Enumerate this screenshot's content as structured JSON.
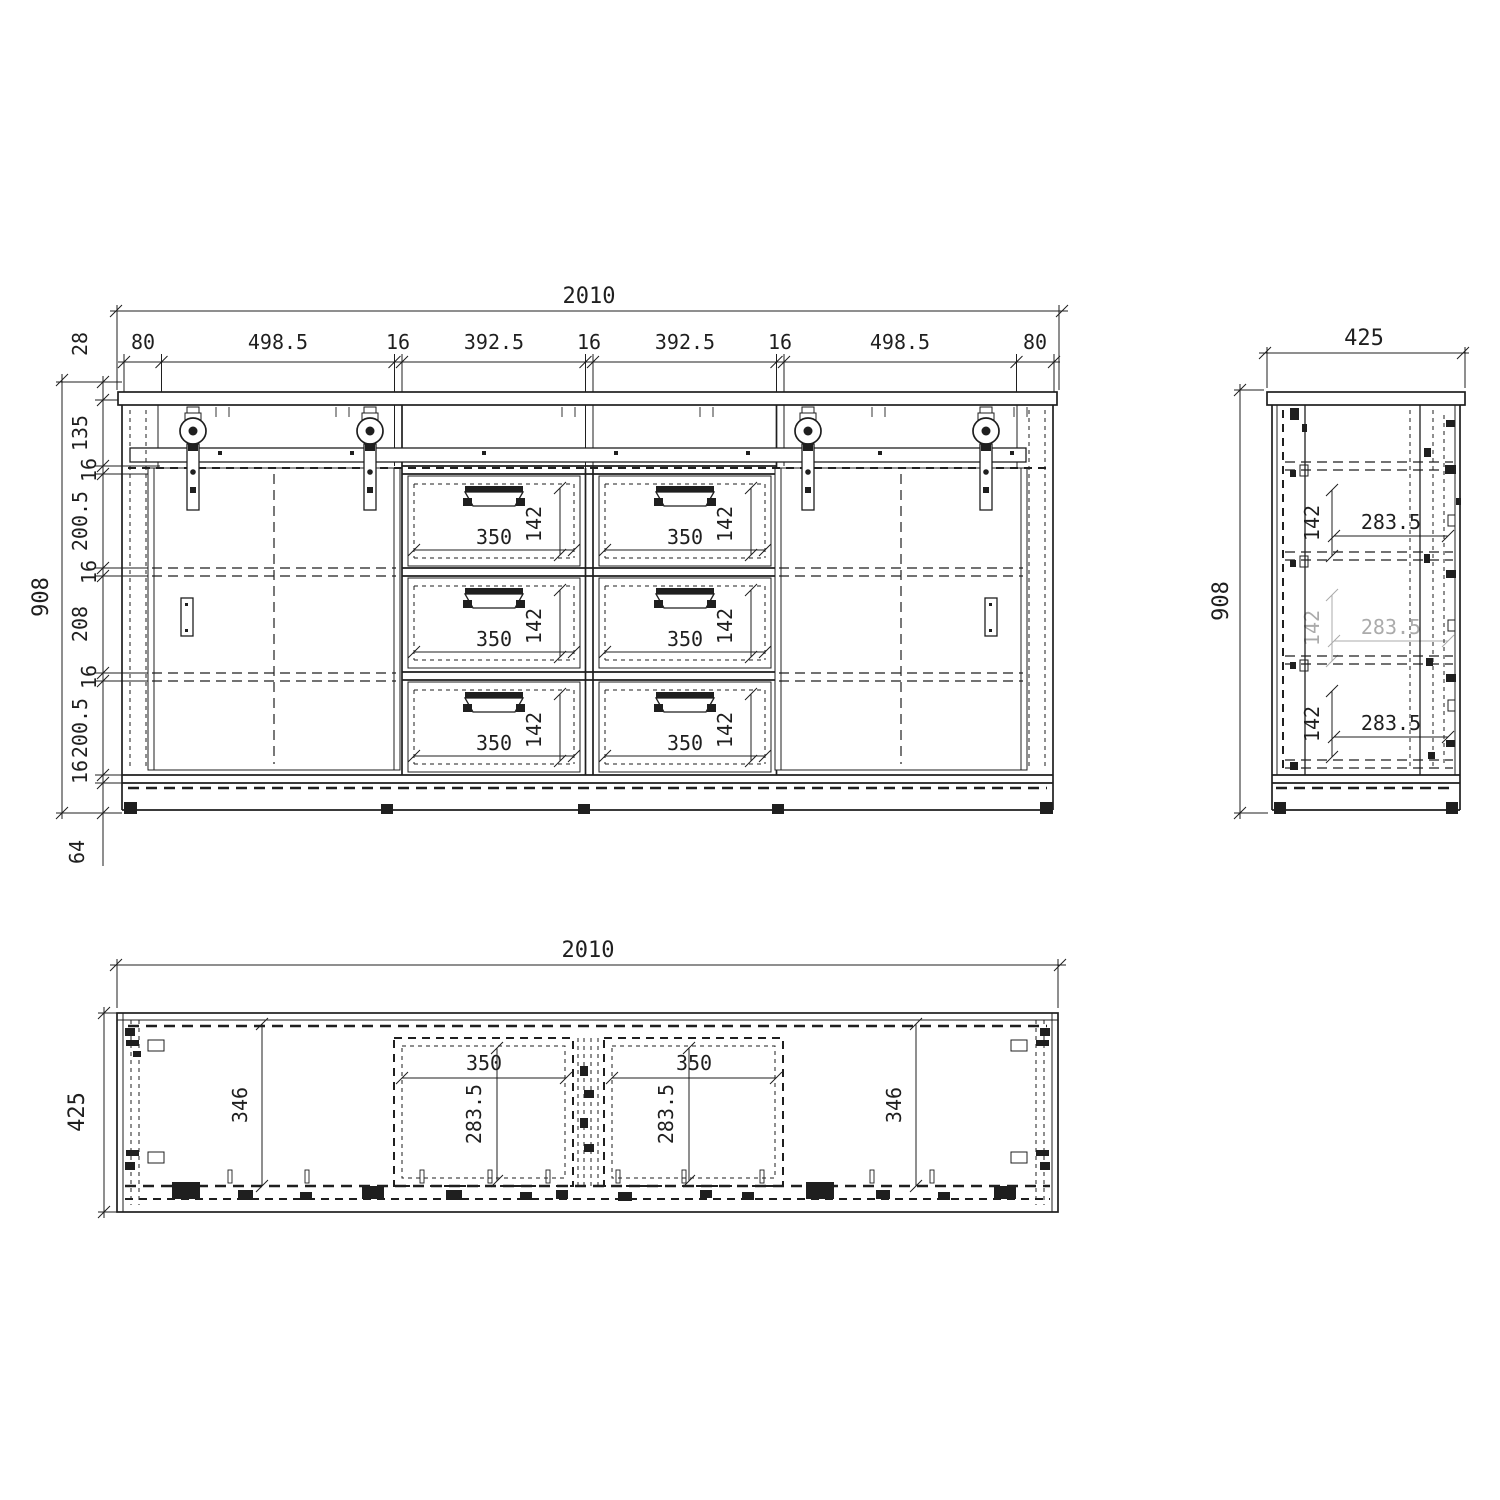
{
  "views": {
    "front": {
      "overall_width": "2010",
      "overall_height": "908",
      "width_chain": [
        "80",
        "498.5",
        "16",
        "392.5",
        "16",
        "392.5",
        "16",
        "498.5",
        "80"
      ],
      "height_chain": [
        "28",
        "135",
        "16",
        "200.5",
        "16",
        "208",
        "16",
        "200.5",
        "16"
      ],
      "plinth_height": "64",
      "drawer_width": "350",
      "drawer_height": "142"
    },
    "side": {
      "overall_depth": "425",
      "overall_height": "908",
      "rows": [
        {
          "depth": "283.5",
          "height": "142"
        },
        {
          "depth": "283.5",
          "height": "142"
        },
        {
          "depth": "283.5",
          "height": "142"
        }
      ]
    },
    "plan": {
      "overall_width": "2010",
      "overall_depth": "425",
      "left_compartment_depth": "346",
      "right_compartment_depth": "346",
      "drawer_widths": [
        "350",
        "350"
      ],
      "drawer_depths": [
        "283.5",
        "283.5"
      ]
    }
  },
  "colors": {
    "line": "#1f1f1f",
    "muted": "#ababab",
    "background": "#ffffff"
  }
}
